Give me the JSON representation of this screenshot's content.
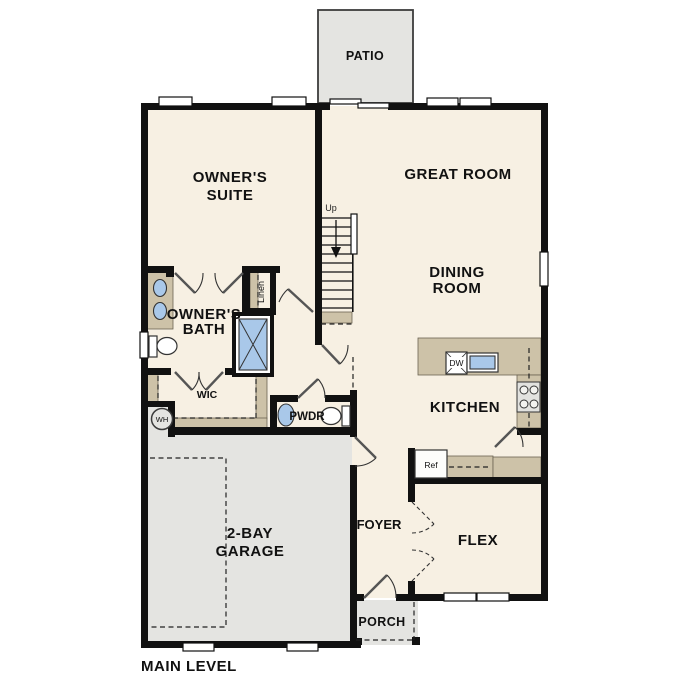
{
  "plan": {
    "footer_label": "MAIN LEVEL",
    "rooms": {
      "patio": "PATIO",
      "owners_suite": [
        "OWNER'S",
        "SUITE"
      ],
      "great_room": "GREAT ROOM",
      "dining_room": [
        "DINING",
        "ROOM"
      ],
      "owners_bath": [
        "OWNER'S",
        "BATH"
      ],
      "wic": "WIC",
      "pwdr": "PWDR",
      "kitchen": "KITCHEN",
      "garage": [
        "2-BAY",
        "GARAGE"
      ],
      "foyer": "FOYER",
      "flex": "FLEX",
      "porch": "PORCH"
    },
    "annotations": {
      "up": "Up",
      "linen": "Linen",
      "wh": "WH",
      "dw": "DW",
      "ref": "Ref",
      "pantry": "Pantry"
    },
    "colors": {
      "floor": "#f7f0e3",
      "wall": "#111111",
      "counter_tan": "#cdc2a8",
      "fixture_blue": "#a9c8e9",
      "concrete_gray": "#e4e4e1",
      "background": "#ffffff"
    }
  }
}
